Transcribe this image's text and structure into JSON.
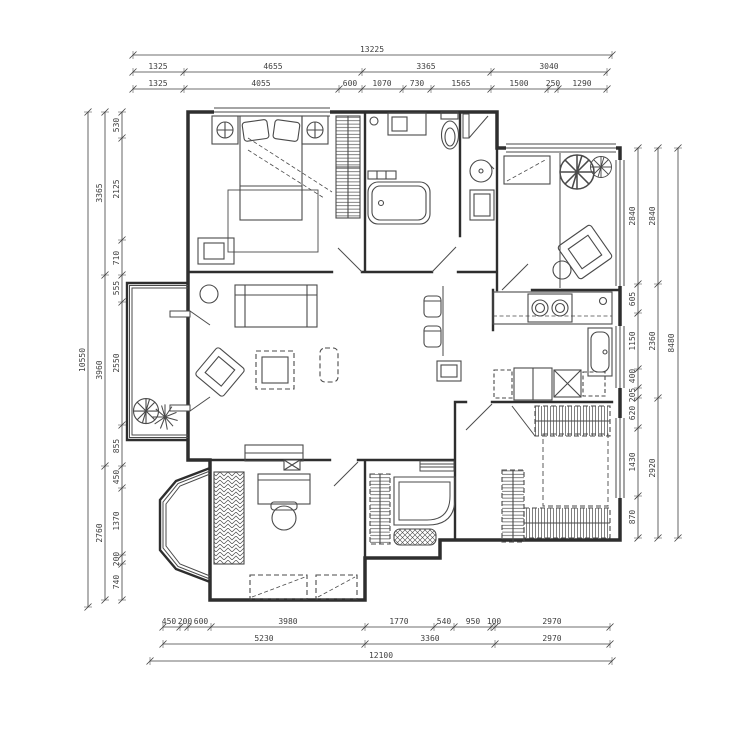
{
  "colors": {
    "wall": "#2e2e2e",
    "furn": "#4a4a4a",
    "dim": "#3f3f3f",
    "background": "#ffffff"
  },
  "dimensions": {
    "top": {
      "overall": "13225",
      "row2": [
        "1325",
        "4655",
        "3365",
        "3040"
      ],
      "row3": [
        "1325",
        "4055",
        "600",
        "1070",
        "730",
        "1565",
        "1500",
        "250",
        "1290"
      ]
    },
    "bottom": {
      "row1": [
        "450",
        "200",
        "600",
        "3980",
        "1770",
        "540",
        "950",
        "100",
        "2970"
      ],
      "row2": [
        "5230",
        "3360",
        "2970"
      ],
      "overall": "12100"
    },
    "left": {
      "overall": "10550",
      "outer": [
        "3365",
        "3960",
        "2760"
      ],
      "inner": [
        "530",
        "2125",
        "710",
        "555",
        "2550",
        "855",
        "450",
        "1370",
        "200",
        "740"
      ]
    },
    "right": {
      "overall": "8480",
      "outer": [
        "2840",
        "2360",
        "2920"
      ],
      "inner": [
        "2840",
        "605",
        "1150",
        "400",
        "205",
        "620",
        "1430",
        "870"
      ]
    }
  }
}
